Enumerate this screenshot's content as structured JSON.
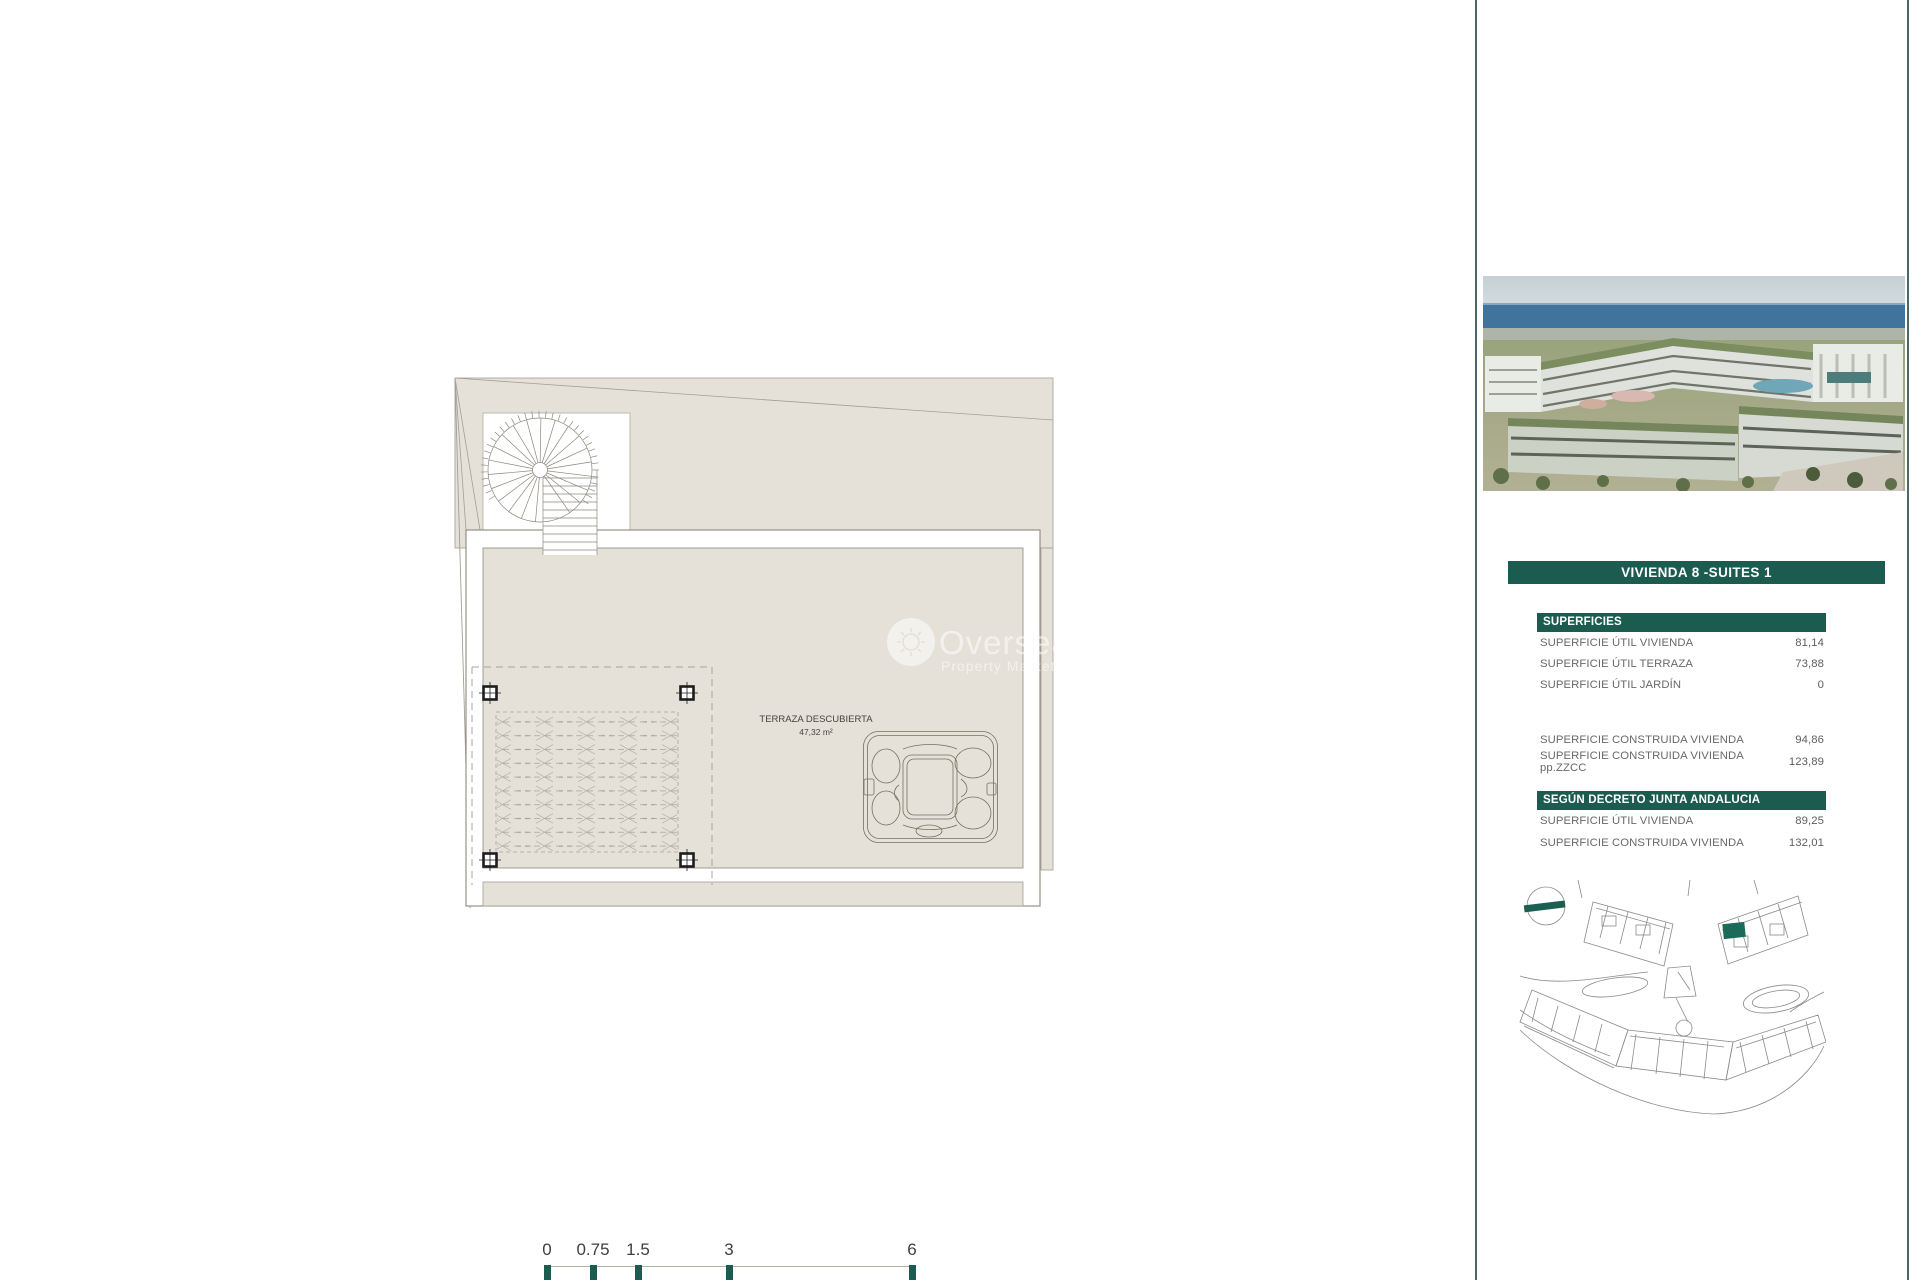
{
  "plan": {
    "room_label": "TERRAZA DESCUBIERTA",
    "room_area": "47,32 m²"
  },
  "watermark": {
    "line1": "Overseas",
    "line2": "Property Market"
  },
  "scale_bar": {
    "labels": [
      "0",
      "0.75",
      "1.5",
      "3",
      "6"
    ]
  },
  "sidebar": {
    "title": "VIVIENDA 8 -SUITES 1",
    "sections": [
      {
        "header": "SUPERFICIES",
        "rows": [
          {
            "label": "SUPERFICIE ÚTIL VIVIENDA",
            "value": "81,14"
          },
          {
            "label": "SUPERFICIE ÚTIL TERRAZA",
            "value": "73,88"
          },
          {
            "label": "SUPERFICIE ÚTIL JARDÍN",
            "value": "0"
          }
        ]
      },
      {
        "rows": [
          {
            "label": "SUPERFICIE CONSTRUIDA VIVIENDA",
            "value": "94,86"
          },
          {
            "label": "SUPERFICIE CONSTRUIDA VIVIENDA pp.ZZCC",
            "value": "123,89"
          }
        ]
      },
      {
        "header": "SEGÚN DECRETO JUNTA ANDALUCIA",
        "rows": [
          {
            "label": "SUPERFICIE ÚTIL VIVIENDA",
            "value": "89,25"
          },
          {
            "label": "SUPERFICIE CONSTRUIDA VIVIENDA",
            "value": "132,01"
          }
        ]
      }
    ]
  },
  "colors": {
    "accent_green": "#1b5b50",
    "divider_teal": "#4c6862",
    "plan_beige": "#e5e1d8",
    "plan_line": "#8b887c"
  }
}
